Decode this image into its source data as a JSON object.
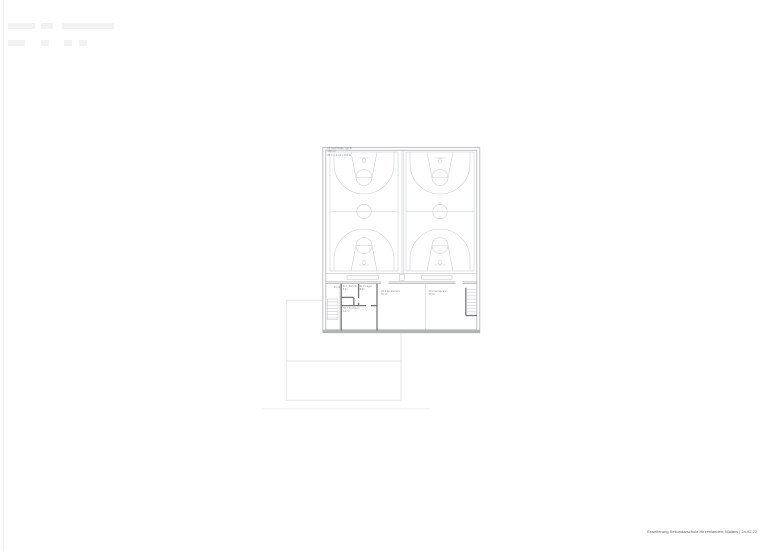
{
  "document": {
    "footer_caption": "Erweiterung Sekundarschule Hirzenlanden, Malans | 24.02.22"
  },
  "plan": {
    "hall_label": "01 Sporthalle Typ B\n968 m²\n45.0 x 24.0 x 9.0 m",
    "ref_mark": "01.05",
    "rooms": {
      "room_1": "02.1 Technik\n8 m²",
      "room_2": "02.2 Lager\n6 m²",
      "room_3": "02.3 Putzraum\n14 m²",
      "equipment_room_1": "03.1 Geräteraum\n50 m²",
      "equipment_room_2": "03.2 Geräteraum\n30 m²"
    },
    "colors": {
      "court_line": "#c9cdd0",
      "wall": "#a9aeb1",
      "wall_dark": "#75797b",
      "partition_light": "#c3c7ca",
      "bench_line": "#bdc2c5",
      "annex": "#dbdee1",
      "label_text": "#85898c",
      "caption_text": "#5f6366"
    }
  }
}
